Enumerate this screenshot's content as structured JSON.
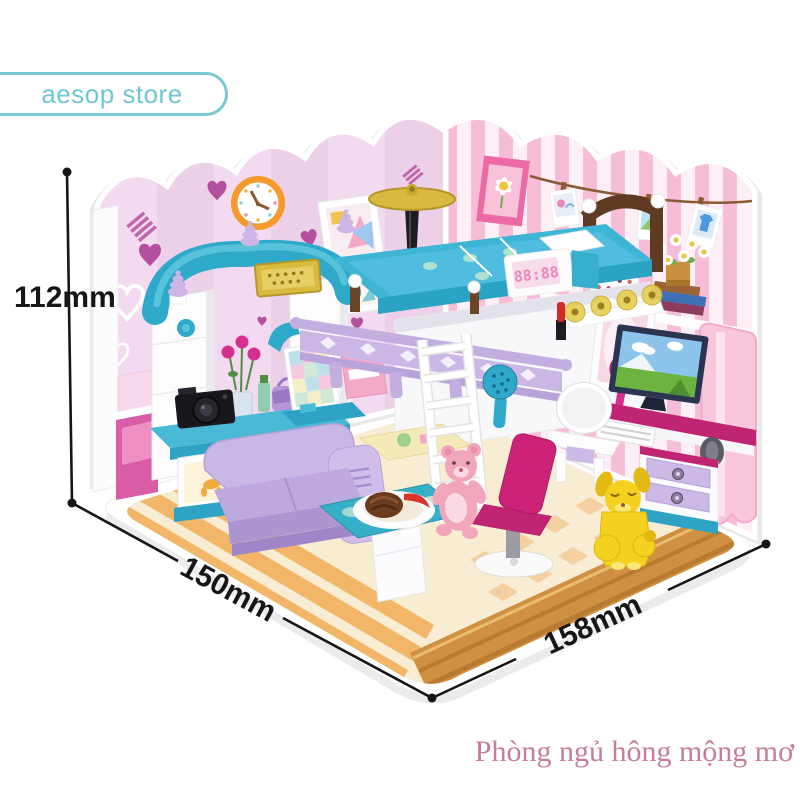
{
  "canvas": {
    "width": 800,
    "height": 800,
    "background": "#ffffff"
  },
  "store_badge": {
    "label": "aesop store",
    "text_color": "#6fc7d1",
    "border_color": "#7bcad2"
  },
  "dimensions": {
    "height": {
      "label": "112mm"
    },
    "depth": {
      "label": "150mm"
    },
    "width": {
      "label": "158mm"
    },
    "line_color": "#161616"
  },
  "caption": {
    "text": "Phòng ngủ hông mộng mơ",
    "color": "#c67c9d"
  },
  "product": {
    "description": "pink dream-bedroom building-block playset diorama",
    "digital_clock_display": "88:88",
    "calendar_label": "Calendar",
    "palette": {
      "wall_left_pink": "#f3daf0",
      "wall_stripe_pink": "#f7bdd7",
      "heart_magenta": "#b4509e",
      "teal": "#2fa9c9",
      "lavender_sofa": "#c9b7e6",
      "magenta_chair": "#cc2277",
      "floor_cream": "#f8ecd2",
      "wood_tan": "#cf9041",
      "gold": "#d8ba3e",
      "bear_pink": "#f2a6bc",
      "puppy_yellow": "#f4d11f",
      "clock_ring_orange": "#f49a2d"
    },
    "scene_elements": [
      "scalloped heart wallpaper wall",
      "striped pink wall",
      "wall clock",
      "picture frames",
      "flower picture",
      "photo string with polaroids",
      "calendar",
      "daisy shelf with books",
      "loft bed with ladder",
      "floor lamp",
      "wardrobe with gold sign",
      "dresser with toy-art drawers",
      "camera",
      "digital alarm clock",
      "vanity mirror with gold flowers",
      "desk with monitor keyboard speakers",
      "lavender sofa",
      "snack table with chocolate donut",
      "magenta swivel chair",
      "pink teddy bear",
      "yellow puppy",
      "wood plank and checker floor"
    ]
  }
}
